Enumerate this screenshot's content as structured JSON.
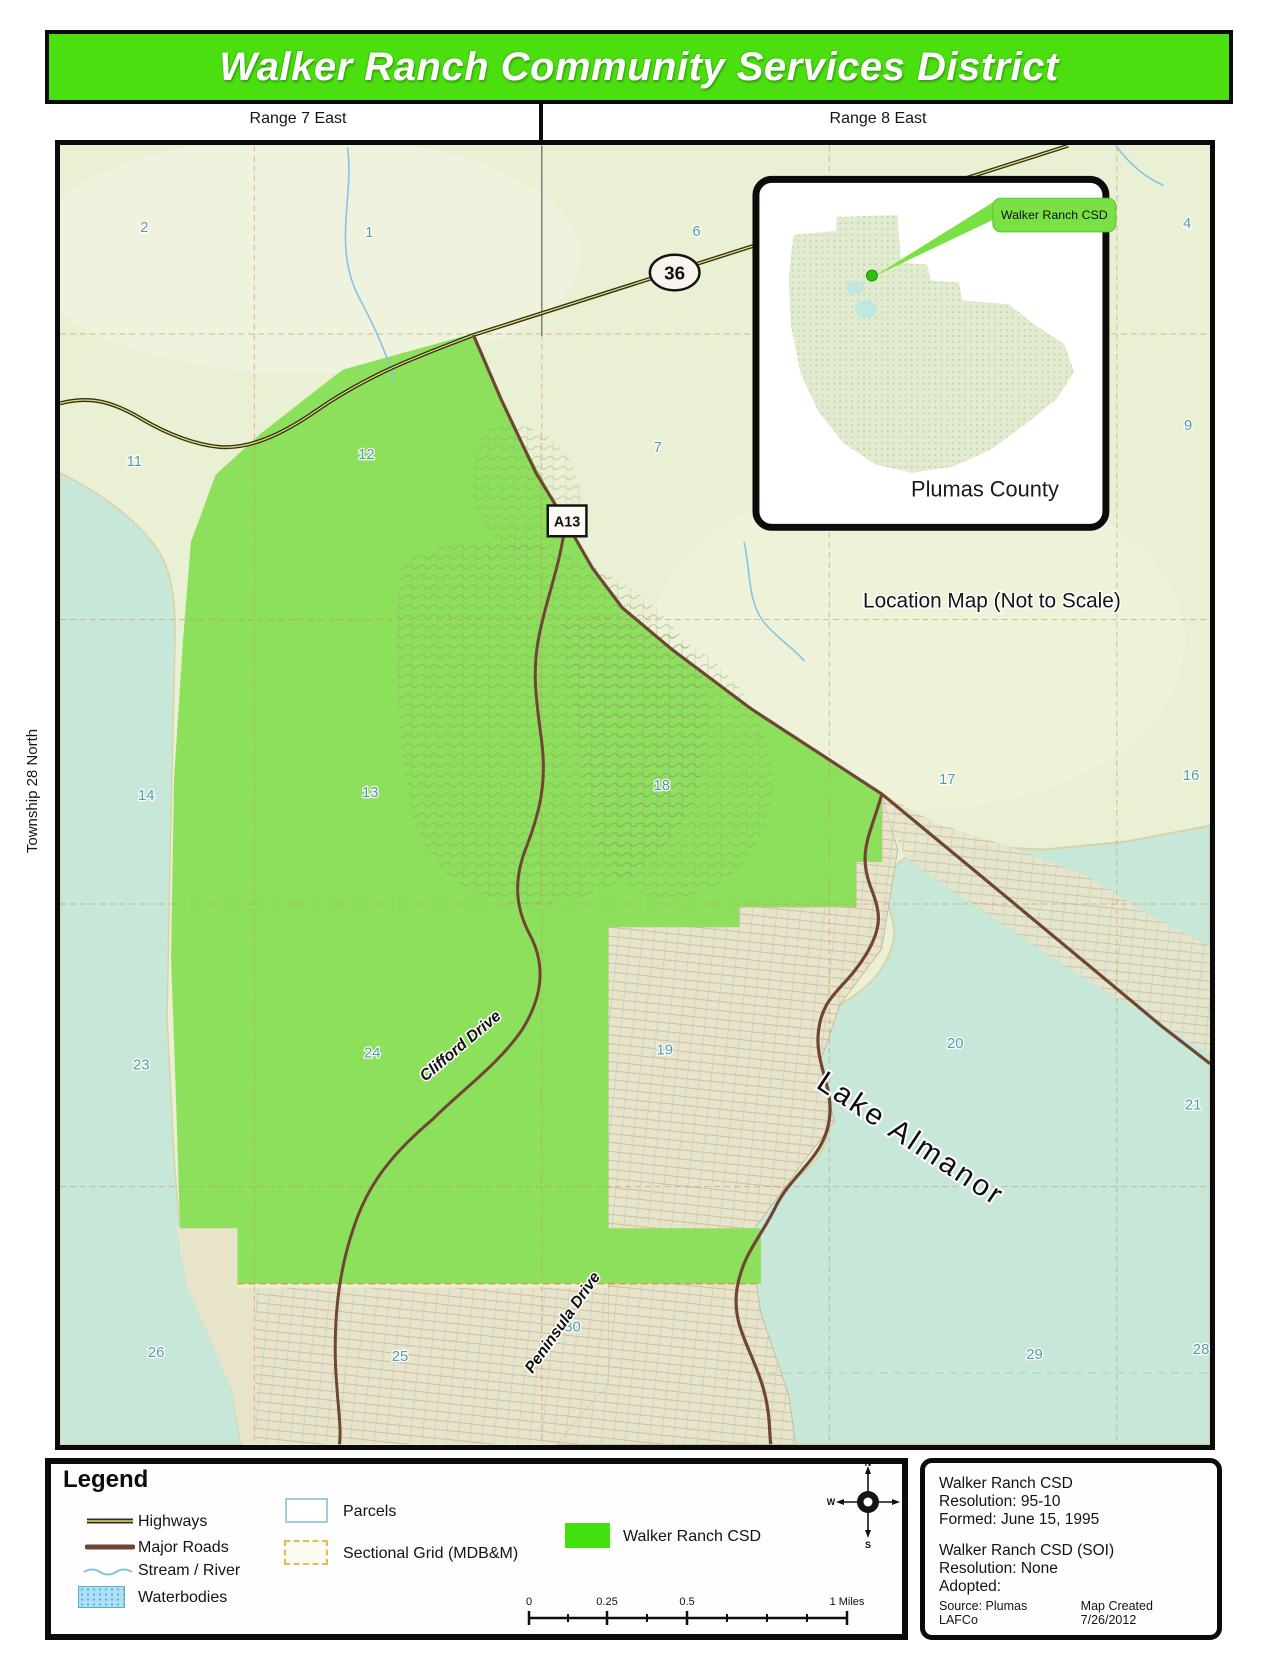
{
  "colors": {
    "title_green": "#4bdf10",
    "csd_green": "#42e00c",
    "callout_green": "#7ae145",
    "land": "#eaf0d3",
    "water": "#c7e7d8",
    "district": "#8de05c",
    "road_major": "#6f4534",
    "highway_dark": "#30311f",
    "highway_core": "#e5dc6a",
    "stream": "#84c4e4",
    "section_num": "#4f98a5",
    "grid_dash": "#c98a5a"
  },
  "title": "Walker Ranch Community Services District",
  "range_labels": {
    "left": "Range 7 East",
    "right": "Range 8 East"
  },
  "township_label": "Township 28 North",
  "map": {
    "sections": [
      "2",
      "1",
      "6",
      "4",
      "11",
      "12",
      "7",
      "9",
      "14",
      "13",
      "18",
      "17",
      "16",
      "23",
      "24",
      "19",
      "20",
      "21",
      "26",
      "25",
      "30",
      "29",
      "28"
    ],
    "highway_shield": "36",
    "road_marker": "A13",
    "road_labels": {
      "clifford": "Clifford Drive",
      "peninsula": "Peninsula Drive"
    },
    "lake_label": "Lake Almanor"
  },
  "inset": {
    "callout": "Walker Ranch CSD",
    "county": "Plumas County",
    "caption": "Location Map (Not to Scale)"
  },
  "legend": {
    "title": "Legend",
    "highways": "Highways",
    "major_roads": "Major Roads",
    "stream": "Stream / River",
    "waterbodies": "Waterbodies",
    "parcels": "Parcels",
    "sectional_grid": "Sectional Grid (MDB&M)",
    "csd": "Walker Ranch CSD"
  },
  "compass": {
    "n": "N",
    "s": "S",
    "e": "E",
    "w": "W"
  },
  "scalebar": {
    "t0": "0",
    "t1": "0.25",
    "t2": "0.5",
    "t3": "1 Miles"
  },
  "info": {
    "lines": [
      "Walker Ranch CSD",
      "Resolution: 95-10",
      "Formed: June 15, 1995",
      "",
      "Walker Ranch CSD (SOI)",
      "Resolution: None",
      "Adopted:"
    ],
    "source1": "Source:  Plumas LAFCo",
    "source2": "Map Created 7/26/2012"
  }
}
